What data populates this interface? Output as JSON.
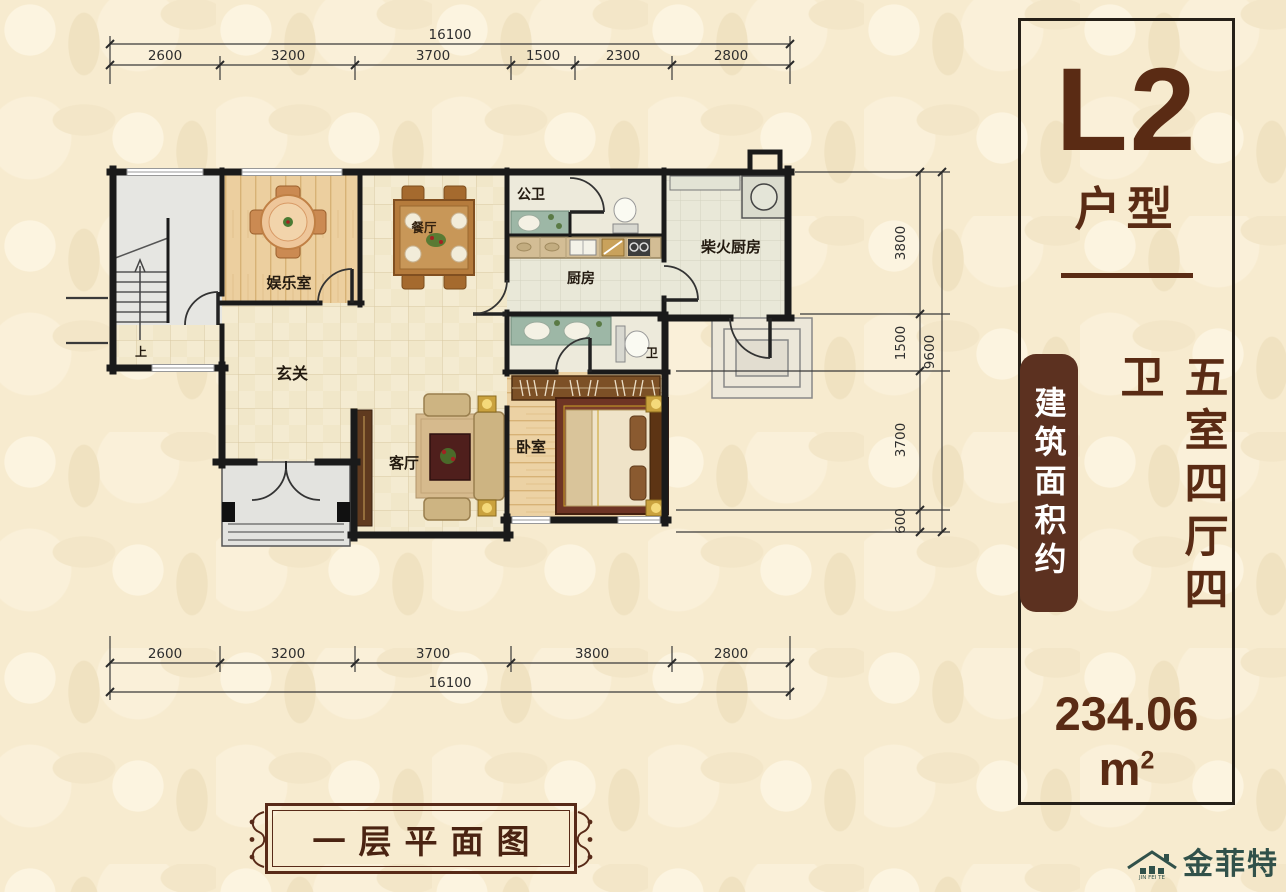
{
  "header": {
    "unit_code": "L2",
    "unit_type_label": "户型",
    "area_prefix": "建筑面积约",
    "layout_summary": "五室四厅四卫",
    "area_value": "234.06",
    "area_unit": "m",
    "area_exponent": "2"
  },
  "plan": {
    "caption": "一层平面图",
    "rooms": {
      "stair_up": "上",
      "entertainment": "娱乐室",
      "dining": "餐厅",
      "public_bath": "公卫",
      "kitchen": "厨房",
      "firewood_kitchen": "柴火厨房",
      "hallway": "玄关",
      "living": "客厅",
      "bedroom": "卧室",
      "bath": "卫"
    }
  },
  "dimensions": {
    "top": {
      "total": "16100",
      "segments": [
        "2600",
        "3200",
        "3700",
        "1500",
        "2300",
        "2800"
      ]
    },
    "bottom": {
      "total": "16100",
      "segments": [
        "2600",
        "3200",
        "3700",
        "3800",
        "2800"
      ]
    },
    "right": {
      "total": "9600",
      "segments": [
        "3800",
        "1500",
        "3700",
        "600"
      ]
    }
  },
  "brand": {
    "name": "金菲特",
    "latin": "JIN FEI TE"
  },
  "colors": {
    "accent_brown": "#5a2b14",
    "badge_brown": "#5c3120",
    "brand_teal": "#31514a",
    "wall_black": "#1a1a1a"
  }
}
